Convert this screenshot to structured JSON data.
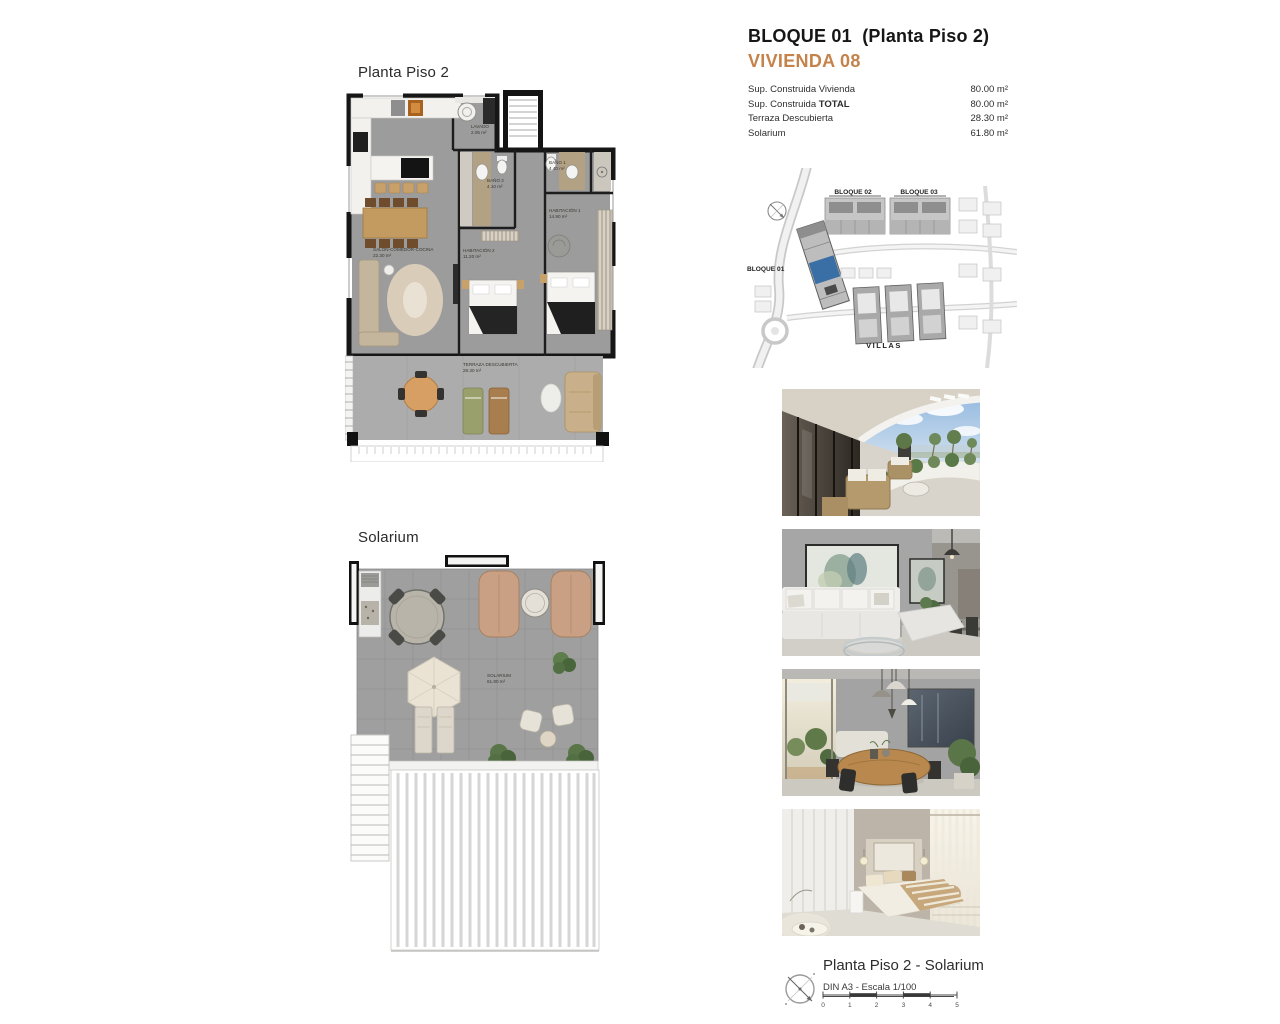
{
  "accent_color": "#c5824a",
  "plan1": {
    "title": "Planta Piso 2",
    "rooms": {
      "lavado": {
        "name": "LAVADO",
        "area": "2.05 m²"
      },
      "bano2": {
        "name": "BAÑO 2",
        "area": "4.10 m²"
      },
      "bano1": {
        "name": "BAÑO 1",
        "area": "4.40 m²"
      },
      "hab1": {
        "name": "HABITACIÓN 1",
        "area": "14.90 m²"
      },
      "hab2": {
        "name": "HABITACIÓN 2",
        "area": "11.20 m²"
      },
      "salon": {
        "name": "SALÓN-COMEDOR-COCINA",
        "area": "22.30 m²"
      },
      "terraza": {
        "name": "TERRAZA DESCUBIERTA",
        "area": "28.30 m²"
      }
    }
  },
  "plan2": {
    "title": "Solarium",
    "rooms": {
      "solarium": {
        "name": "SOLARIUM",
        "area": "61.80 m²"
      }
    }
  },
  "header": {
    "block_title": "BLOQUE 01  (Planta Piso 2)",
    "unit_title": "VIVIENDA 08",
    "specs": [
      {
        "label": "Sup. Construida Vivienda",
        "strong": "",
        "value": "80.00 m²"
      },
      {
        "label": "Sup. Construida ",
        "strong": "TOTAL",
        "value": "80.00 m²"
      },
      {
        "label": "Terraza Descubierta",
        "strong": "",
        "value": "28.30 m²"
      },
      {
        "label": "Solarium",
        "strong": "",
        "value": "61.80 m²"
      }
    ]
  },
  "siteplan": {
    "bloque01": "BLOQUE 01",
    "bloque02": "BLOQUE 02",
    "bloque03": "BLOQUE 03",
    "villas": "VILLAS",
    "highlight_color": "#3a6fa5"
  },
  "photos": [
    {
      "name": "terrace-balcony-sea-view"
    },
    {
      "name": "living-room-corner-sofa"
    },
    {
      "name": "dining-room-wood-table"
    },
    {
      "name": "bedroom-wardrobe-bed"
    }
  ],
  "footer": {
    "title": "Planta Piso 2 - Solarium",
    "subtitle": "DIN A3 - Escala 1/100",
    "scale_ticks": [
      "0",
      "1",
      "2",
      "3",
      "4",
      "5"
    ]
  }
}
